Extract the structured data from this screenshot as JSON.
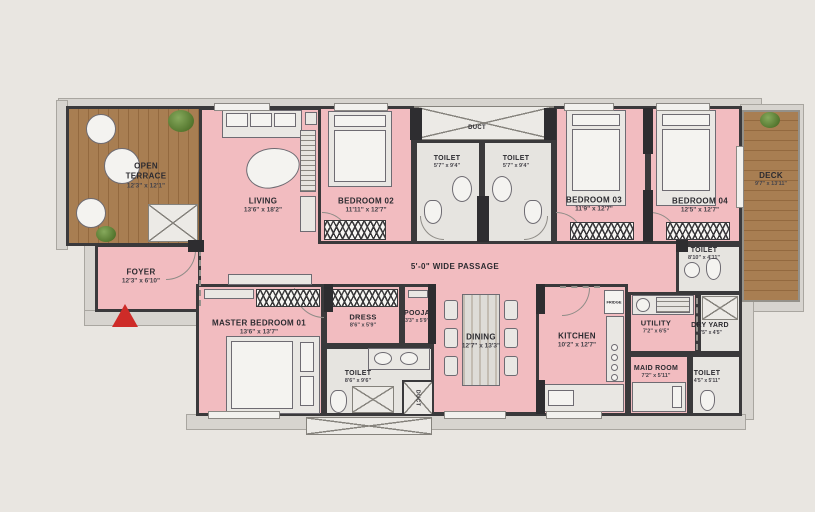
{
  "colors": {
    "bg": "#e9e6e1",
    "pink": "#f2bcc0",
    "wall": "#3a393b",
    "wood": "#a87e52",
    "woodline": "#93693f",
    "ledge": "#d7d4cf",
    "arrow": "#ce2b28",
    "fur": "#e9e7e3",
    "floor": "#e6e4e0"
  },
  "rooms": {
    "open_terrace": {
      "name": "OPEN TERRACE",
      "dims": "12'3\" x 12'1\""
    },
    "living": {
      "name": "LIVING",
      "dims": "13'6\" x 18'2\""
    },
    "foyer": {
      "name": "FOYER",
      "dims": "12'3\" x 6'10\""
    },
    "bedroom2": {
      "name": "BEDROOM 02",
      "dims": "11'11\" x 12'7\""
    },
    "toilet_a": {
      "name": "TOILET",
      "dims": "5'7\" x 9'4\""
    },
    "toilet_b": {
      "name": "TOILET",
      "dims": "5'7\" x 9'4\""
    },
    "bedroom3": {
      "name": "BEDROOM 03",
      "dims": "11'9\" x 12'7\""
    },
    "bedroom4": {
      "name": "BEDROOM 04",
      "dims": "12'5\" x 12'7\""
    },
    "deck": {
      "name": "DECK",
      "dims": "9'7\" x 13'11\""
    },
    "toilet_bed4": {
      "name": "TOILET",
      "dims": "8'10\" x 4'11\""
    },
    "master_bedroom": {
      "name": "MASTER BEDROOM 01",
      "dims": "13'6\" x 13'7\""
    },
    "dress": {
      "name": "DRESS",
      "dims": "8'6\" x 5'9\""
    },
    "pooja": {
      "name": "POOJA",
      "dims": "3'3\" x 5'9\""
    },
    "toilet_master": {
      "name": "TOILET",
      "dims": "8'6\" x 9'6\""
    },
    "dining": {
      "name": "DINING",
      "dims": "12'7\" x 13'3\""
    },
    "kitchen": {
      "name": "KITCHEN",
      "dims": "10'2\" x 12'7\""
    },
    "utility": {
      "name": "UTILITY",
      "dims": "7'2\" x 6'5\""
    },
    "dry_yard": {
      "name": "DRY YARD",
      "dims": "4'5\" x 4'5\""
    },
    "maid_room": {
      "name": "MAID ROOM",
      "dims": "7'2\" x 5'11\""
    },
    "toilet_maid": {
      "name": "TOILET",
      "dims": "4'5\" x 5'11\""
    }
  },
  "labels": {
    "passage": "5'-0\" WIDE PASSAGE",
    "duct_top": "DUCT",
    "duct_bottom": "DUCT",
    "fridge": "FRIDGE"
  }
}
